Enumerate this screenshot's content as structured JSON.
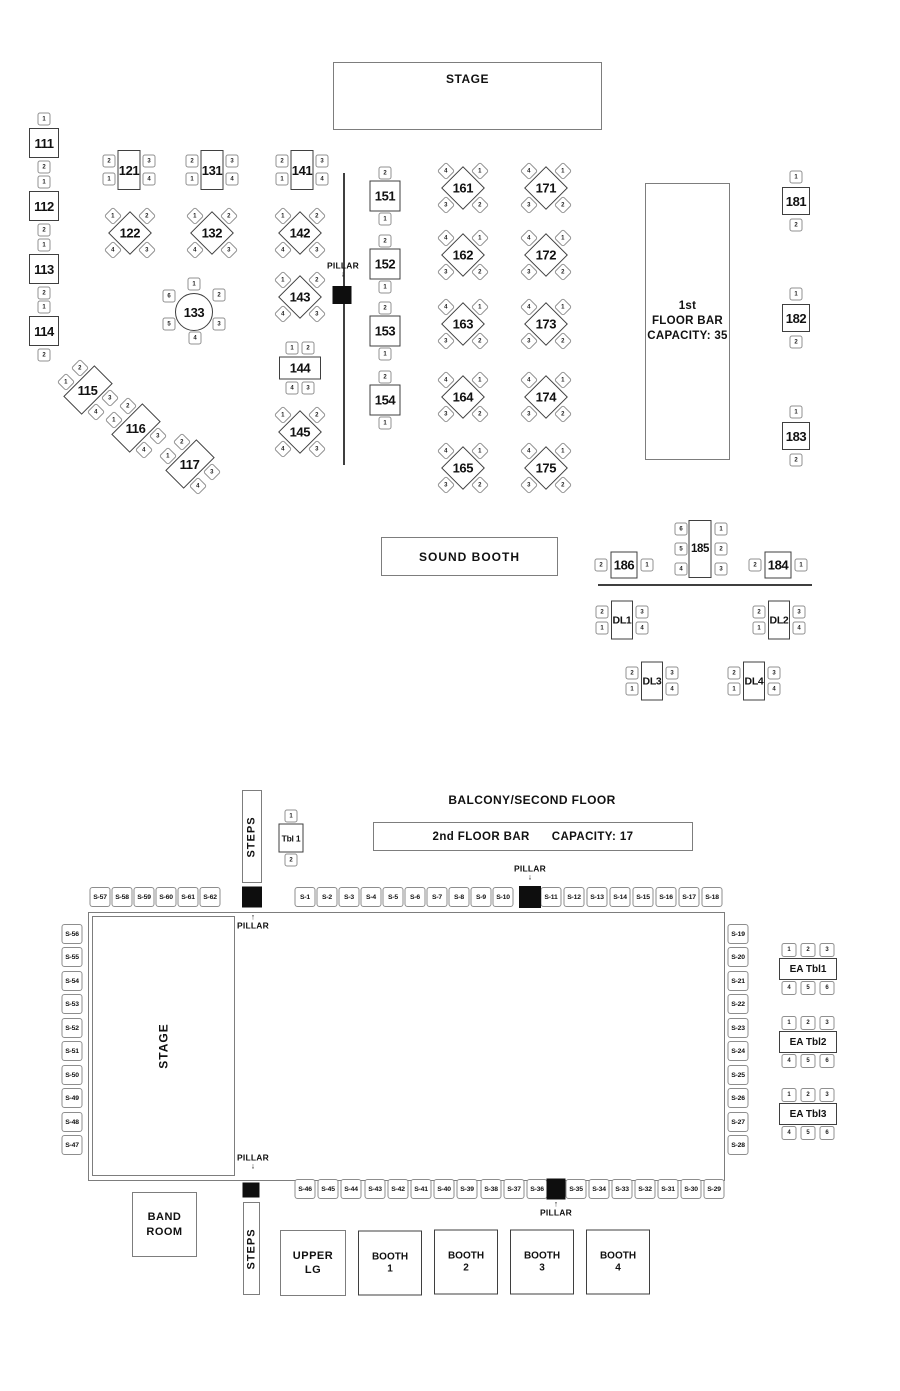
{
  "floor1": {
    "stage_label": "STAGE",
    "bar": {
      "line1": "1st",
      "line2": "FLOOR BAR",
      "line3": "CAPACITY: 35"
    },
    "sound_booth_label": "SOUND BOOTH"
  },
  "floor2": {
    "heading": "BALCONY/SECOND FLOOR",
    "bar": {
      "left": "2nd FLOOR BAR",
      "right": "CAPACITY: 17"
    },
    "stage_label": "STAGE",
    "steps_top_label": "STEPS",
    "steps_bottom_label": "STEPS",
    "band_room": {
      "line1": "BAND",
      "line2": "ROOM"
    },
    "upper_lg": {
      "line1": "UPPER",
      "line2": "LG"
    }
  },
  "floor_plan": {
    "pillar_label": "PILLAR",
    "table_types": {
      "sqTB": {
        "w": 30,
        "h": 30,
        "chairs": [
          {
            "n": "1",
            "dx": 0,
            "dy": -24
          },
          {
            "n": "2",
            "dx": 0,
            "dy": 24
          }
        ]
      },
      "sq21": {
        "w": 31,
        "h": 31,
        "chairs": [
          {
            "n": "2",
            "dx": 0,
            "dy": -23
          },
          {
            "n": "1",
            "dx": 0,
            "dy": 23
          }
        ]
      },
      "sq12": {
        "w": 28,
        "h": 28,
        "chairs": [
          {
            "n": "1",
            "dx": 0,
            "dy": -24
          },
          {
            "n": "2",
            "dx": 0,
            "dy": 24
          }
        ]
      },
      "sqLR": {
        "w": 27,
        "h": 27,
        "chairs": [
          {
            "n": "2",
            "dx": -23,
            "dy": 0
          },
          {
            "n": "1",
            "dx": 23,
            "dy": 0
          }
        ]
      },
      "vrect4": {
        "w": 23,
        "h": 40,
        "chairs": [
          {
            "n": "2",
            "dx": -20,
            "dy": -9
          },
          {
            "n": "1",
            "dx": -20,
            "dy": 9
          },
          {
            "n": "3",
            "dx": 20,
            "dy": -9
          },
          {
            "n": "4",
            "dx": 20,
            "dy": 9
          }
        ]
      },
      "diaA": {
        "w": 31,
        "h": 31,
        "rot": true,
        "chairRot": true,
        "chairs": [
          {
            "n": "1",
            "dx": -17,
            "dy": -17
          },
          {
            "n": "2",
            "dx": 17,
            "dy": -17
          },
          {
            "n": "4",
            "dx": -17,
            "dy": 17
          },
          {
            "n": "3",
            "dx": 17,
            "dy": 17
          }
        ]
      },
      "diaB": {
        "w": 31,
        "h": 31,
        "rot": true,
        "chairRot": true,
        "chairs": [
          {
            "n": "4",
            "dx": -17,
            "dy": -17
          },
          {
            "n": "1",
            "dx": 17,
            "dy": -17
          },
          {
            "n": "3",
            "dx": -17,
            "dy": 17
          },
          {
            "n": "2",
            "dx": 17,
            "dy": 17
          }
        ]
      },
      "round6": {
        "w": 38,
        "h": 38,
        "round": true,
        "chairs": [
          {
            "n": "1",
            "dx": 0,
            "dy": -28
          },
          {
            "n": "2",
            "dx": 25,
            "dy": -17
          },
          {
            "n": "3",
            "dx": 25,
            "dy": 12
          },
          {
            "n": "4",
            "dx": 1,
            "dy": 26
          },
          {
            "n": "5",
            "dx": -25,
            "dy": 12
          },
          {
            "n": "6",
            "dx": -25,
            "dy": -16
          }
        ]
      },
      "hrect4": {
        "w": 42,
        "h": 23,
        "chairs": [
          {
            "n": "1",
            "dx": -8,
            "dy": -20
          },
          {
            "n": "2",
            "dx": 8,
            "dy": -20
          },
          {
            "n": "4",
            "dx": -8,
            "dy": 20
          },
          {
            "n": "3",
            "dx": 8,
            "dy": 20
          }
        ]
      },
      "tilt4": {
        "w": 26,
        "h": 44,
        "rot": true,
        "chairRot": true,
        "chairs": [
          {
            "n": "2",
            "dx": -8,
            "dy": -22
          },
          {
            "n": "1",
            "dx": -22,
            "dy": -8
          },
          {
            "n": "3",
            "dx": 22,
            "dy": 8
          },
          {
            "n": "4",
            "dx": 8,
            "dy": 22
          }
        ]
      },
      "vrect6": {
        "w": 23,
        "h": 58,
        "cls": "t-185",
        "chairs": [
          {
            "n": "6",
            "dx": -19,
            "dy": -20
          },
          {
            "n": "5",
            "dx": -19,
            "dy": 0
          },
          {
            "n": "4",
            "dx": -19,
            "dy": 20
          },
          {
            "n": "1",
            "dx": 21,
            "dy": -20
          },
          {
            "n": "2",
            "dx": 21,
            "dy": 0
          },
          {
            "n": "3",
            "dx": 21,
            "dy": 20
          }
        ]
      },
      "dl": {
        "w": 22,
        "h": 39,
        "cls": "t-dl",
        "chairs": [
          {
            "n": "2",
            "dx": -20,
            "dy": -8
          },
          {
            "n": "1",
            "dx": -20,
            "dy": 8
          },
          {
            "n": "3",
            "dx": 20,
            "dy": -8
          },
          {
            "n": "4",
            "dx": 20,
            "dy": 8
          }
        ]
      },
      "tbl1": {
        "w": 25,
        "h": 29,
        "cls": "t-tbl1",
        "chairs": [
          {
            "n": "1",
            "dx": 0,
            "dy": -22
          },
          {
            "n": "2",
            "dx": 0,
            "dy": 22
          }
        ]
      },
      "ea": {
        "w": 58,
        "h": 22,
        "cls": "t-ea",
        "cw": 15,
        "ch": 14,
        "chairs": [
          {
            "n": "1",
            "dx": -19,
            "dy": -19
          },
          {
            "n": "2",
            "dx": 0,
            "dy": -19
          },
          {
            "n": "3",
            "dx": 19,
            "dy": -19
          },
          {
            "n": "4",
            "dx": -19,
            "dy": 19
          },
          {
            "n": "5",
            "dx": 0,
            "dy": 19
          },
          {
            "n": "6",
            "dx": 19,
            "dy": 19
          }
        ]
      },
      "booth": {
        "w": 64,
        "h": 65,
        "cls": "t-booth",
        "cw": 14,
        "ch": 14,
        "chairs": [
          {
            "n": "1",
            "dx": -24,
            "dy": -22
          },
          {
            "n": "2",
            "dx": -24,
            "dy": -2
          },
          {
            "n": "3",
            "dx": -24,
            "dy": 19
          },
          {
            "n": "4",
            "dx": 20,
            "dy": -22
          },
          {
            "n": "5",
            "dx": 20,
            "dy": -2
          },
          {
            "n": "6",
            "dx": 20,
            "dy": 19
          }
        ]
      }
    },
    "tables": [
      {
        "id": "111",
        "type": "sqTB",
        "x": 44,
        "y": 143
      },
      {
        "id": "112",
        "type": "sqTB",
        "x": 44,
        "y": 206
      },
      {
        "id": "113",
        "type": "sqTB",
        "x": 44,
        "y": 269
      },
      {
        "id": "114",
        "type": "sqTB",
        "x": 44,
        "y": 331
      },
      {
        "id": "121",
        "type": "vrect4",
        "x": 129,
        "y": 170
      },
      {
        "id": "131",
        "type": "vrect4",
        "x": 212,
        "y": 170
      },
      {
        "id": "141",
        "type": "vrect4",
        "x": 302,
        "y": 170
      },
      {
        "id": "122",
        "type": "diaA",
        "x": 130,
        "y": 233
      },
      {
        "id": "132",
        "type": "diaA",
        "x": 212,
        "y": 233
      },
      {
        "id": "142",
        "type": "diaA",
        "x": 300,
        "y": 233
      },
      {
        "id": "133",
        "type": "round6",
        "x": 194,
        "y": 312
      },
      {
        "id": "143",
        "type": "diaA",
        "x": 300,
        "y": 297
      },
      {
        "id": "144",
        "type": "hrect4",
        "x": 300,
        "y": 368
      },
      {
        "id": "145",
        "type": "diaA",
        "x": 300,
        "y": 432
      },
      {
        "id": "115",
        "type": "tilt4",
        "x": 88,
        "y": 390
      },
      {
        "id": "116",
        "type": "tilt4",
        "x": 136,
        "y": 428
      },
      {
        "id": "117",
        "type": "tilt4",
        "x": 190,
        "y": 464
      },
      {
        "id": "151",
        "type": "sq21",
        "x": 385,
        "y": 196
      },
      {
        "id": "152",
        "type": "sq21",
        "x": 385,
        "y": 264
      },
      {
        "id": "153",
        "type": "sq21",
        "x": 385,
        "y": 331
      },
      {
        "id": "154",
        "type": "sq21",
        "x": 385,
        "y": 400
      },
      {
        "id": "161",
        "type": "diaB",
        "x": 463,
        "y": 188
      },
      {
        "id": "162",
        "type": "diaB",
        "x": 463,
        "y": 255
      },
      {
        "id": "163",
        "type": "diaB",
        "x": 463,
        "y": 324
      },
      {
        "id": "164",
        "type": "diaB",
        "x": 463,
        "y": 397
      },
      {
        "id": "165",
        "type": "diaB",
        "x": 463,
        "y": 468
      },
      {
        "id": "171",
        "type": "diaB",
        "x": 546,
        "y": 188
      },
      {
        "id": "172",
        "type": "diaB",
        "x": 546,
        "y": 255
      },
      {
        "id": "173",
        "type": "diaB",
        "x": 546,
        "y": 324
      },
      {
        "id": "174",
        "type": "diaB",
        "x": 546,
        "y": 397
      },
      {
        "id": "175",
        "type": "diaB",
        "x": 546,
        "y": 468
      },
      {
        "id": "181",
        "type": "sq12",
        "x": 796,
        "y": 201
      },
      {
        "id": "182",
        "type": "sq12",
        "x": 796,
        "y": 318
      },
      {
        "id": "183",
        "type": "sq12",
        "x": 796,
        "y": 436
      },
      {
        "id": "186",
        "type": "sqLR",
        "x": 624,
        "y": 565
      },
      {
        "id": "185",
        "type": "vrect6",
        "x": 700,
        "y": 549
      },
      {
        "id": "184",
        "type": "sqLR",
        "x": 778,
        "y": 565
      },
      {
        "id": "DL1",
        "type": "dl",
        "x": 622,
        "y": 620
      },
      {
        "id": "DL2",
        "type": "dl",
        "x": 779,
        "y": 620
      },
      {
        "id": "DL3",
        "type": "dl",
        "x": 652,
        "y": 681
      },
      {
        "id": "DL4",
        "type": "dl",
        "x": 754,
        "y": 681
      },
      {
        "id": "Tbl 1",
        "type": "tbl1",
        "x": 291,
        "y": 838
      },
      {
        "id": "EA Tbl1",
        "type": "ea",
        "x": 808,
        "y": 969
      },
      {
        "id": "EA Tbl2",
        "type": "ea",
        "x": 808,
        "y": 1042
      },
      {
        "id": "EA Tbl3",
        "type": "ea",
        "x": 808,
        "y": 1114
      },
      {
        "id": "BOOTH 1",
        "type": "booth",
        "lines": [
          "BOOTH",
          "1"
        ],
        "x": 390,
        "y": 1263
      },
      {
        "id": "BOOTH 2",
        "type": "booth",
        "lines": [
          "BOOTH",
          "2"
        ],
        "x": 466,
        "y": 1262
      },
      {
        "id": "BOOTH 3",
        "type": "booth",
        "lines": [
          "BOOTH",
          "3"
        ],
        "x": 542,
        "y": 1262
      },
      {
        "id": "BOOTH 4",
        "type": "booth",
        "lines": [
          "BOOTH",
          "4"
        ],
        "x": 618,
        "y": 1262
      }
    ],
    "seats": [
      {
        "label": "S-57",
        "x": 100,
        "y": 897
      },
      {
        "label": "S-58",
        "x": 122,
        "y": 897
      },
      {
        "label": "S-59",
        "x": 144,
        "y": 897
      },
      {
        "label": "S-60",
        "x": 166,
        "y": 897
      },
      {
        "label": "S-61",
        "x": 188,
        "y": 897
      },
      {
        "label": "S-62",
        "x": 210,
        "y": 897
      },
      {
        "label": "S-1",
        "x": 305,
        "y": 897
      },
      {
        "label": "S-2",
        "x": 327,
        "y": 897
      },
      {
        "label": "S-3",
        "x": 349,
        "y": 897
      },
      {
        "label": "S-4",
        "x": 371,
        "y": 897
      },
      {
        "label": "S-5",
        "x": 393,
        "y": 897
      },
      {
        "label": "S-6",
        "x": 415,
        "y": 897
      },
      {
        "label": "S-7",
        "x": 437,
        "y": 897
      },
      {
        "label": "S-8",
        "x": 459,
        "y": 897
      },
      {
        "label": "S-9",
        "x": 481,
        "y": 897
      },
      {
        "label": "S-10",
        "x": 503,
        "y": 897
      },
      {
        "label": "S-11",
        "x": 551,
        "y": 897
      },
      {
        "label": "S-12",
        "x": 574,
        "y": 897
      },
      {
        "label": "S-13",
        "x": 597,
        "y": 897
      },
      {
        "label": "S-14",
        "x": 620,
        "y": 897
      },
      {
        "label": "S-15",
        "x": 643,
        "y": 897
      },
      {
        "label": "S-16",
        "x": 666,
        "y": 897
      },
      {
        "label": "S-17",
        "x": 689,
        "y": 897
      },
      {
        "label": "S-18",
        "x": 712,
        "y": 897
      },
      {
        "label": "S-56",
        "x": 72,
        "y": 934
      },
      {
        "label": "S-55",
        "x": 72,
        "y": 957
      },
      {
        "label": "S-54",
        "x": 72,
        "y": 981
      },
      {
        "label": "S-53",
        "x": 72,
        "y": 1004
      },
      {
        "label": "S-52",
        "x": 72,
        "y": 1028
      },
      {
        "label": "S-51",
        "x": 72,
        "y": 1051
      },
      {
        "label": "S-50",
        "x": 72,
        "y": 1075
      },
      {
        "label": "S-49",
        "x": 72,
        "y": 1098
      },
      {
        "label": "S-48",
        "x": 72,
        "y": 1122
      },
      {
        "label": "S-47",
        "x": 72,
        "y": 1145
      },
      {
        "label": "S-19",
        "x": 738,
        "y": 934
      },
      {
        "label": "S-20",
        "x": 738,
        "y": 957
      },
      {
        "label": "S-21",
        "x": 738,
        "y": 981
      },
      {
        "label": "S-22",
        "x": 738,
        "y": 1004
      },
      {
        "label": "S-23",
        "x": 738,
        "y": 1028
      },
      {
        "label": "S-24",
        "x": 738,
        "y": 1051
      },
      {
        "label": "S-25",
        "x": 738,
        "y": 1075
      },
      {
        "label": "S-26",
        "x": 738,
        "y": 1098
      },
      {
        "label": "S-27",
        "x": 738,
        "y": 1122
      },
      {
        "label": "S-28",
        "x": 738,
        "y": 1145
      },
      {
        "label": "S-46",
        "x": 305,
        "y": 1189
      },
      {
        "label": "S-45",
        "x": 328,
        "y": 1189
      },
      {
        "label": "S-44",
        "x": 351,
        "y": 1189
      },
      {
        "label": "S-43",
        "x": 375,
        "y": 1189
      },
      {
        "label": "S-42",
        "x": 398,
        "y": 1189
      },
      {
        "label": "S-41",
        "x": 421,
        "y": 1189
      },
      {
        "label": "S-40",
        "x": 444,
        "y": 1189
      },
      {
        "label": "S-39",
        "x": 467,
        "y": 1189
      },
      {
        "label": "S-38",
        "x": 491,
        "y": 1189
      },
      {
        "label": "S-37",
        "x": 514,
        "y": 1189
      },
      {
        "label": "S-36",
        "x": 537,
        "y": 1189
      },
      {
        "label": "S-35",
        "x": 576,
        "y": 1189
      },
      {
        "label": "S-34",
        "x": 599,
        "y": 1189
      },
      {
        "label": "S-33",
        "x": 622,
        "y": 1189
      },
      {
        "label": "S-32",
        "x": 645,
        "y": 1189
      },
      {
        "label": "S-31",
        "x": 668,
        "y": 1189
      },
      {
        "label": "S-30",
        "x": 691,
        "y": 1189
      },
      {
        "label": "S-29",
        "x": 714,
        "y": 1189
      }
    ],
    "pillars": [
      {
        "x": 342,
        "y": 295,
        "w": 19,
        "h": 18
      },
      {
        "x": 252,
        "y": 897,
        "w": 20,
        "h": 21
      },
      {
        "x": 530,
        "y": 897,
        "w": 22,
        "h": 22
      },
      {
        "x": 251,
        "y": 1190,
        "w": 17,
        "h": 15
      },
      {
        "x": 556,
        "y": 1189,
        "w": 19,
        "h": 21
      }
    ],
    "pillar_labels": [
      {
        "label": "PILLAR",
        "x": 343,
        "y": 270,
        "dir": "down"
      },
      {
        "label": "PILLAR",
        "x": 530,
        "y": 873,
        "dir": "down"
      },
      {
        "label": "PILLAR",
        "x": 253,
        "y": 922,
        "dir": "up"
      },
      {
        "label": "PILLAR",
        "x": 253,
        "y": 1162,
        "dir": "down"
      },
      {
        "label": "PILLAR",
        "x": 556,
        "y": 1209,
        "dir": "up"
      }
    ],
    "lines": [
      {
        "x": 343,
        "y": 173,
        "len": 292,
        "o": "v"
      },
      {
        "x": 598,
        "y": 584,
        "len": 214,
        "o": "h"
      }
    ]
  }
}
